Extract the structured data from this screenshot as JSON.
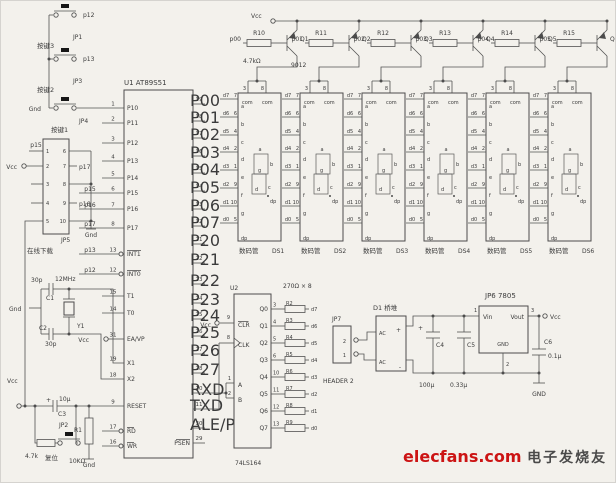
{
  "colors": {
    "wire": "#525252",
    "text": "#3b3b3b",
    "brand_red": "#cc1414",
    "brand_gray": "#4a4a4a"
  },
  "buttons": {
    "gnd": "Gnd",
    "items": [
      {
        "name": "按键3",
        "jp": "JP1",
        "net": "p12"
      },
      {
        "name": "按键2",
        "jp": "JP3",
        "net": "p13"
      },
      {
        "name": "按键1",
        "jp": "JP4",
        "net": ""
      }
    ]
  },
  "isp": {
    "ref": "JP5",
    "label": "在线下载",
    "gnd": "Gnd",
    "vcc": "Vcc",
    "left_nums": [
      "1",
      "2",
      "3",
      "4",
      "5"
    ],
    "right_nums": [
      "6",
      "7",
      "8",
      "9",
      "10"
    ],
    "pin1_net": "p15",
    "pin7_net": "p17",
    "pin9_net": "p16"
  },
  "mcu": {
    "ref": "U1",
    "part": "AT89S51",
    "left_pins": [
      {
        "name": "P10",
        "num": "1"
      },
      {
        "name": "P11",
        "num": "2"
      },
      {
        "name": "P12",
        "num": "3"
      },
      {
        "name": "P13",
        "num": "4"
      },
      {
        "name": "P14",
        "num": "5"
      },
      {
        "name": "P15",
        "num": "6",
        "net": "p15"
      },
      {
        "name": "P16",
        "num": "7",
        "net": "p16"
      },
      {
        "name": "P17",
        "num": "8",
        "net": "p17"
      },
      {
        "name": "INT1",
        "num": "13",
        "net": "p13",
        "over": true,
        "bubble": true
      },
      {
        "name": "INT0",
        "num": "12",
        "net": "p12",
        "over": true,
        "bubble": true
      },
      {
        "name": "T1",
        "num": "15"
      },
      {
        "name": "T0",
        "num": "14"
      },
      {
        "name": "EA/VP",
        "num": "31",
        "vcc": "Vcc"
      },
      {
        "name": "X1",
        "num": "19"
      },
      {
        "name": "X2",
        "num": "18"
      },
      {
        "name": "RESET",
        "num": "9"
      },
      {
        "name": "RD",
        "num": "17",
        "over": true,
        "bubble": true
      },
      {
        "name": "WR",
        "num": "16",
        "over": true,
        "bubble": true
      }
    ],
    "right_pins": [
      {
        "name": "P00",
        "num": "39"
      },
      {
        "name": "P01",
        "num": "38"
      },
      {
        "name": "P02",
        "num": "37"
      },
      {
        "name": "P03",
        "num": "36"
      },
      {
        "name": "P04",
        "num": "35"
      },
      {
        "name": "P05",
        "num": "34"
      },
      {
        "name": "P06",
        "num": "33"
      },
      {
        "name": "P07",
        "num": "32"
      },
      {
        "name": "P20",
        "num": "21"
      },
      {
        "name": "P21",
        "num": "22"
      },
      {
        "name": "P22",
        "num": "23"
      },
      {
        "name": "P23",
        "num": "24"
      },
      {
        "name": "P24",
        "num": "25"
      },
      {
        "name": "P25",
        "num": "26"
      },
      {
        "name": "P26",
        "num": "27"
      },
      {
        "name": "P27",
        "num": "28"
      },
      {
        "name": "RXD",
        "num": "10",
        "custom": true
      },
      {
        "name": "TXD",
        "num": "11",
        "custom": true
      },
      {
        "name": "ALE/P",
        "num": "30"
      },
      {
        "name": "PSEN",
        "num": "29",
        "over": true
      }
    ]
  },
  "crystal": {
    "gnd": "Gnd",
    "c1": "C1",
    "c1_val": "30p",
    "freq": "12MHz",
    "ref": "Y1",
    "c2": "C2",
    "c2_val": "30p"
  },
  "reset": {
    "vcc": "Vcc",
    "plus": "+",
    "cap": "C3",
    "cap_val": "10μ",
    "jp": "JP2",
    "r2_val": "4.7k",
    "r2_label": "复位",
    "r1": "R1",
    "r1_val": "10KΩ",
    "gnd": "Gnd"
  },
  "drivers": {
    "vcc": "Vcc",
    "base_res_val": "4.7kΩ",
    "transistor_type": "9012",
    "cells": [
      {
        "input": "p00",
        "res": "R10",
        "q": "Q1"
      },
      {
        "input": "p01",
        "res": "R11",
        "q": "Q2"
      },
      {
        "input": "p02",
        "res": "R12",
        "q": "Q3"
      },
      {
        "input": "p03",
        "res": "R13",
        "q": "Q4"
      },
      {
        "input": "p04",
        "res": "R14",
        "q": "Q5"
      },
      {
        "input": "p05",
        "res": "R15",
        "q": "Q6"
      }
    ]
  },
  "displays": {
    "label": "数码管",
    "refs": [
      "DS1",
      "DS2",
      "DS3",
      "DS4",
      "DS5",
      "DS6"
    ],
    "com": "com",
    "com_pins": [
      "3",
      "8"
    ],
    "pins": [
      {
        "net": "d7",
        "num": "7"
      },
      {
        "net": "d6",
        "num": "6"
      },
      {
        "net": "d5",
        "num": "4"
      },
      {
        "net": "d4",
        "num": "2"
      },
      {
        "net": "d3",
        "num": "1"
      },
      {
        "net": "d2",
        "num": "9"
      },
      {
        "net": "d1",
        "num": "10"
      },
      {
        "net": "d0",
        "num": "5"
      }
    ],
    "seg_letters": [
      "a",
      "b",
      "c",
      "d",
      "e",
      "f",
      "g",
      "dp"
    ]
  },
  "shift_reg": {
    "ref": "U2",
    "part": "74LS164",
    "vcc": "Vcc",
    "array_label": "270Ω × 8",
    "clr": {
      "name": "CLR",
      "num": "9"
    },
    "clk": {
      "name": "CLK",
      "num": "8"
    },
    "a": {
      "name": "A",
      "num": "1"
    },
    "b": {
      "name": "B",
      "num": "2"
    },
    "outputs": [
      {
        "name": "Q0",
        "num": "3",
        "res": "R2",
        "net": "d7"
      },
      {
        "name": "Q1",
        "num": "4",
        "res": "R3",
        "net": "d6"
      },
      {
        "name": "Q2",
        "num": "5",
        "res": "R4",
        "net": "d5"
      },
      {
        "name": "Q3",
        "num": "6",
        "res": "R5",
        "net": "d4"
      },
      {
        "name": "Q4",
        "num": "10",
        "res": "R6",
        "net": "d3"
      },
      {
        "name": "Q5",
        "num": "11",
        "res": "R7",
        "net": "d2"
      },
      {
        "name": "Q6",
        "num": "12",
        "res": "R8",
        "net": "d1"
      },
      {
        "name": "Q7",
        "num": "13",
        "res": "R9",
        "net": "d0"
      }
    ]
  },
  "power": {
    "jp7": {
      "ref": "JP7",
      "label": "HEADER 2",
      "nums": [
        "2",
        "1"
      ]
    },
    "bridge": {
      "ref": "D1",
      "label": "桥堆",
      "ac_top": "AC",
      "plus": "+",
      "ac_bot": "AC",
      "minus": "-"
    },
    "c4": {
      "ref": "C4",
      "val": "100μ",
      "plus": "+"
    },
    "c5": {
      "ref": "C5",
      "val": "0.33μ"
    },
    "reg": {
      "ref": "JP6",
      "part": "7805",
      "vin": "Vin",
      "vout": "Vout",
      "gnd": "GND",
      "pin_in": "1",
      "pin_out": "3",
      "pin_gnd": "2"
    },
    "c6": {
      "ref": "C6",
      "val": "0.1μ"
    },
    "vcc": "Vcc",
    "gnd": "GND"
  },
  "watermark": {
    "site": "elecfans",
    "dot": ".",
    "tld": "com",
    "cn": "电子发烧友"
  }
}
